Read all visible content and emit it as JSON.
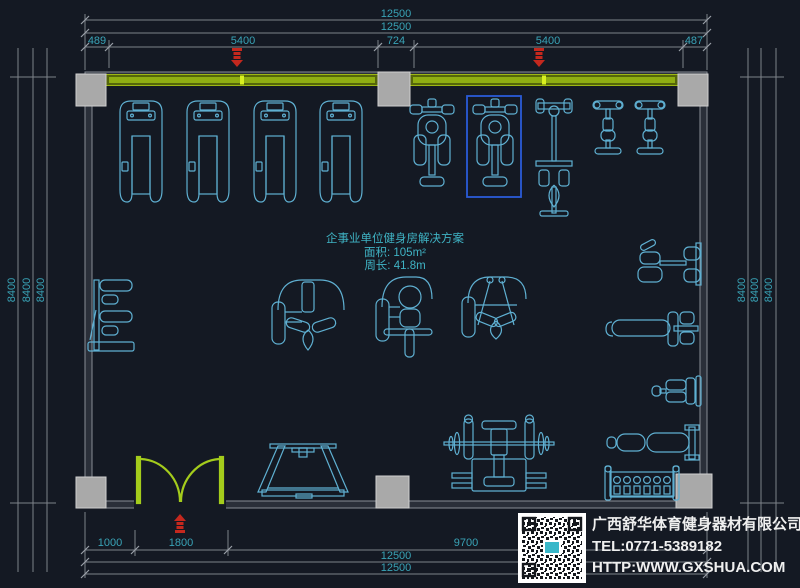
{
  "plan": {
    "title": "企事业单位健身房解决方案",
    "area": "面积: 105m²",
    "perimeter": "周长: 41.8m"
  },
  "dimensions": {
    "top_total_1": "12500",
    "top_total_2": "12500",
    "top_segments": [
      "489",
      "5400",
      "724",
      "5400",
      "487"
    ],
    "bottom_segments": [
      "1000",
      "1800",
      "9700"
    ],
    "bottom_total_1": "12500",
    "bottom_total_2": "12500",
    "left": [
      "8400",
      "8400",
      "8400"
    ],
    "right": [
      "8400",
      "8400",
      "8400"
    ]
  },
  "title_block": {
    "company": "广西舒华体育健身器材有限公司",
    "tel": "TEL:0771-5389182",
    "website": "HTTP:WWW.GXSHUA.COM"
  },
  "colors": {
    "background": "#141923",
    "equipment_cyan": "#5fb0d2",
    "dimension_text_teal": "#39a3b6",
    "dimension_line_gray": "#7d828a",
    "window_band_green": "#8aa812",
    "door_green": "#a4cc1c",
    "marker_red": "#c4281e",
    "selection_blue": "#2a5bd7",
    "column_gray": "#a9a9a9",
    "company_text": "#efefef"
  },
  "equipment_icons": [
    "treadmill-icon",
    "elliptical-icon",
    "cable-tower-icon",
    "exercise-bike-icon",
    "leg-curl-station-icon",
    "pec-fly-machine-icon",
    "seated-press-machine-icon",
    "lat-machine-icon",
    "shoulder-press-icon",
    "adjustable-bench-icon",
    "flat-bench-icon",
    "utility-bench-icon",
    "dumbbell-rack-icon",
    "sit-up-rack-icon",
    "bench-press-icon",
    "qr-code",
    "window-marker-icon",
    "door-marker-icon"
  ]
}
